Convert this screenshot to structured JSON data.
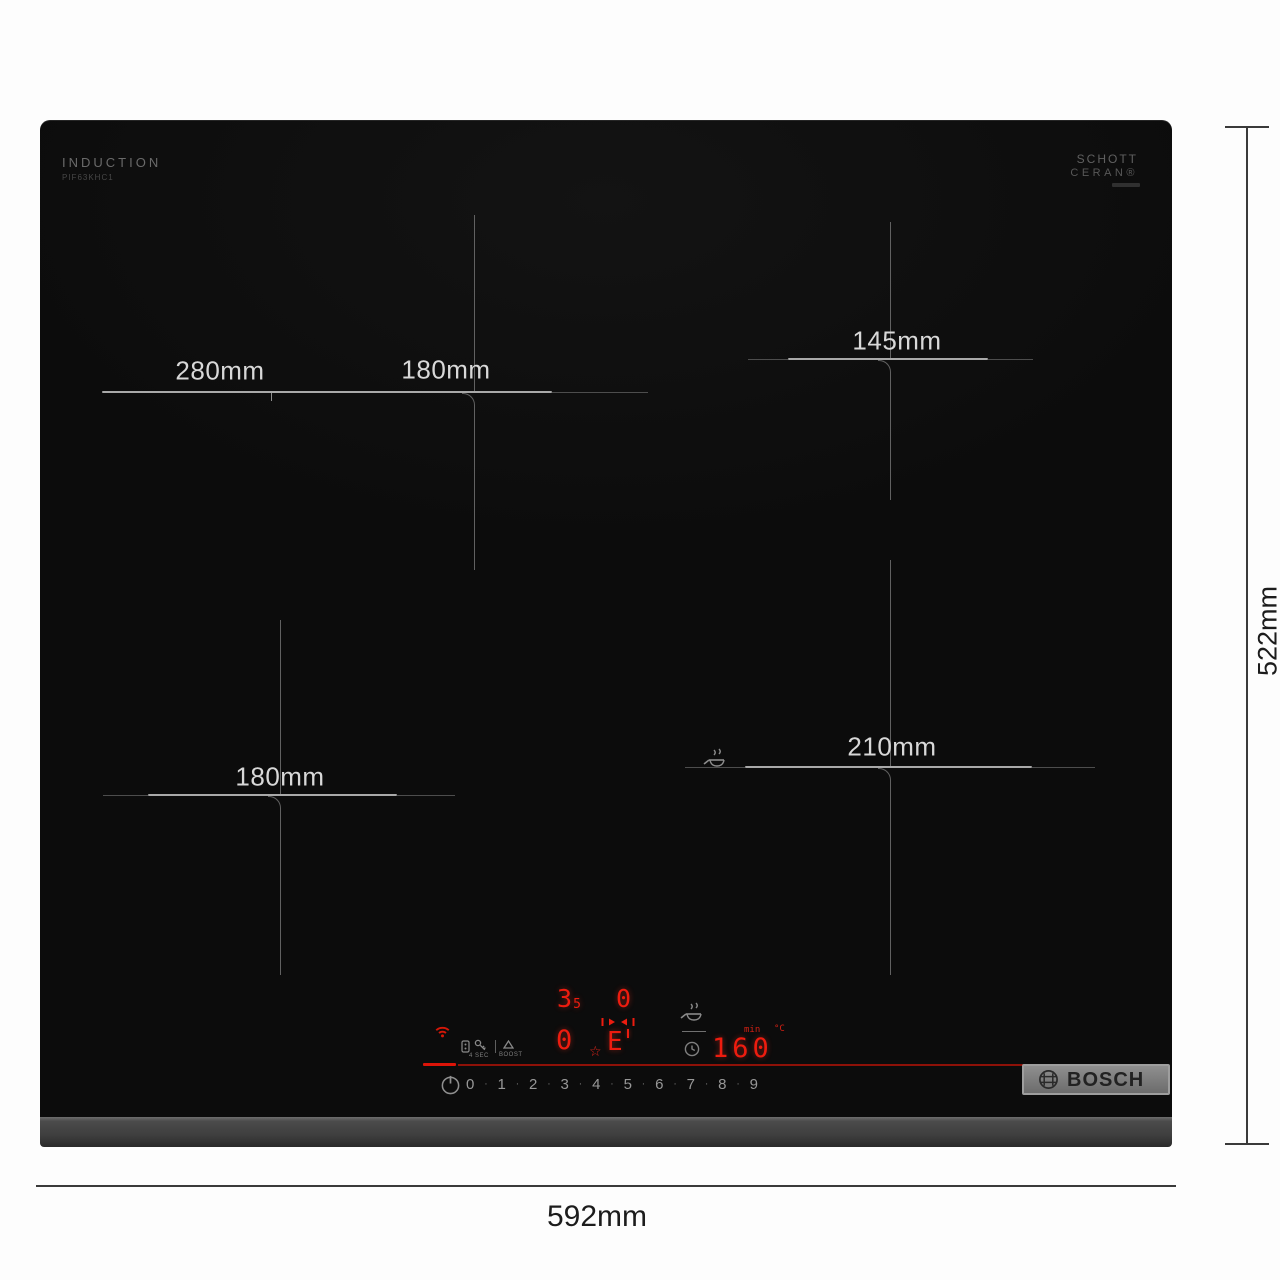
{
  "product": {
    "type_label": "INDUCTION",
    "model_code": "PIF63KHC1",
    "glass_brand_line1": "SCHOTT",
    "glass_brand_line2": "CERAN®",
    "logo_text": "BOSCH"
  },
  "dimension_annotations": {
    "width": "592mm",
    "height": "522mm"
  },
  "cooking_zones": [
    {
      "name": "rear-left-flex",
      "size_labels": [
        "280mm",
        "180mm"
      ]
    },
    {
      "name": "rear-right",
      "size_labels": [
        "145mm"
      ]
    },
    {
      "name": "front-left",
      "size_labels": [
        "180mm"
      ]
    },
    {
      "name": "front-right-fry-sensor",
      "size_labels": [
        "210mm"
      ]
    }
  ],
  "control_panel": {
    "display": {
      "rear_left_level_main": "3",
      "rear_left_level_sub": "5",
      "rear_right_level": "0",
      "front_left_level": "0",
      "front_right_symbol": "E",
      "timer_value": "160",
      "unit_min": "min",
      "unit_temp": "°C"
    },
    "printed_labels": {
      "lock_hold": "4 SEC",
      "boost": "BOOST"
    },
    "power_levels": [
      "0",
      "1",
      "2",
      "3",
      "4",
      "5",
      "6",
      "7",
      "8",
      "9"
    ],
    "separator": "·",
    "star_glyph": "☆"
  },
  "colors": {
    "led_red": "#ed1c0f",
    "accent_line_red": "#dc1408",
    "glass_black": "#0c0c0c"
  }
}
